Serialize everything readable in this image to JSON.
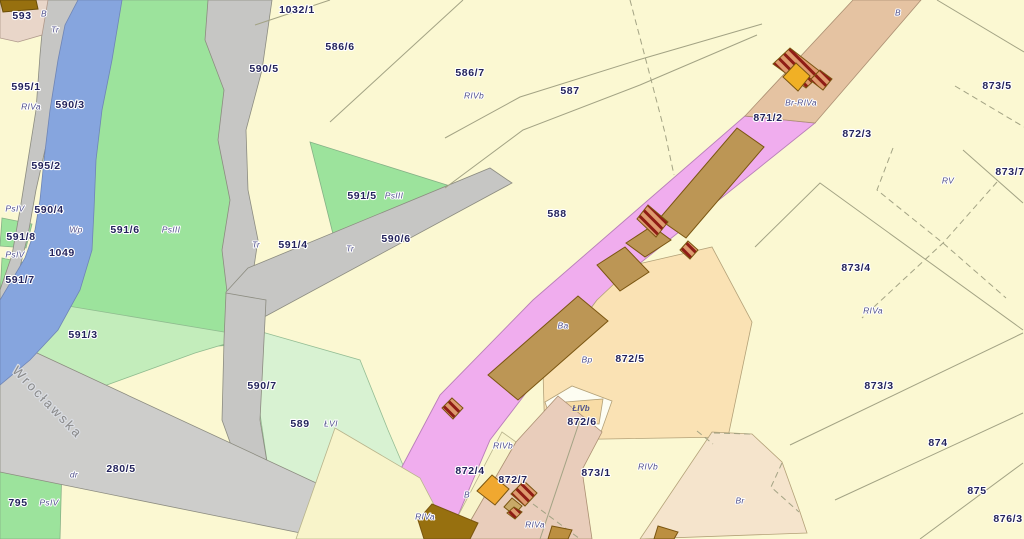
{
  "map": {
    "type": "cadastral-parcel-map",
    "street_label": "Wrocławska",
    "colors": {
      "background_parcel": "#FBF8D2",
      "meadow_green": "#9CE39C",
      "light_green": "#C3EDBB",
      "lighter_green": "#D8F2D2",
      "river_blue": "#86A5DE",
      "road_gray": "#C6C6C4",
      "railway_pink": "#F0ADEE",
      "building_brown": "#BC9655",
      "building_dark_brown": "#97700F",
      "building_orange": "#F0A830",
      "tan_band": "#E5C3A2",
      "tan_bottom": "#E9CDBB",
      "peach": "#FAE2B4",
      "ruin_hatch_red": "#8F1D15",
      "label_navy": "#23235C",
      "label_landuse": "#50508C"
    },
    "labels": [
      {
        "t": "593",
        "x": 22,
        "y": 16,
        "s": "p"
      },
      {
        "t": "B",
        "x": 44,
        "y": 14,
        "s": "l"
      },
      {
        "t": "Tr",
        "x": 55,
        "y": 30,
        "s": "l"
      },
      {
        "t": "1032/1",
        "x": 297,
        "y": 10,
        "s": "p"
      },
      {
        "t": "586/6",
        "x": 340,
        "y": 47,
        "s": "p"
      },
      {
        "t": "590/5",
        "x": 264,
        "y": 69,
        "s": "p"
      },
      {
        "t": "586/7",
        "x": 470,
        "y": 73,
        "s": "p"
      },
      {
        "t": "587",
        "x": 570,
        "y": 91,
        "s": "p"
      },
      {
        "t": "RIVb",
        "x": 474,
        "y": 96,
        "s": "l"
      },
      {
        "t": "595/1",
        "x": 26,
        "y": 87,
        "s": "p"
      },
      {
        "t": "590/3",
        "x": 70,
        "y": 105,
        "s": "p"
      },
      {
        "t": "RIVa",
        "x": 31,
        "y": 107,
        "s": "l"
      },
      {
        "t": "B",
        "x": 898,
        "y": 13,
        "s": "l"
      },
      {
        "t": "871/2",
        "x": 768,
        "y": 118,
        "s": "p"
      },
      {
        "t": "Br-RIVa",
        "x": 801,
        "y": 103,
        "s": "l"
      },
      {
        "t": "872/3",
        "x": 857,
        "y": 134,
        "s": "p"
      },
      {
        "t": "873/5",
        "x": 997,
        "y": 86,
        "s": "p"
      },
      {
        "t": "595/2",
        "x": 46,
        "y": 166,
        "s": "p"
      },
      {
        "t": "591/5",
        "x": 362,
        "y": 196,
        "s": "p"
      },
      {
        "t": "PsIII",
        "x": 394,
        "y": 196,
        "s": "l"
      },
      {
        "t": "873/7",
        "x": 1010,
        "y": 172,
        "s": "p"
      },
      {
        "t": "RV",
        "x": 948,
        "y": 181,
        "s": "l"
      },
      {
        "t": "PsIV",
        "x": 15,
        "y": 209,
        "s": "l"
      },
      {
        "t": "590/4",
        "x": 49,
        "y": 210,
        "s": "p"
      },
      {
        "t": "588",
        "x": 557,
        "y": 214,
        "s": "p"
      },
      {
        "t": "Wp",
        "x": 76,
        "y": 230,
        "s": "l"
      },
      {
        "t": "591/6",
        "x": 125,
        "y": 230,
        "s": "p"
      },
      {
        "t": "PsIII",
        "x": 171,
        "y": 230,
        "s": "l"
      },
      {
        "t": "591/8",
        "x": 21,
        "y": 237,
        "s": "p"
      },
      {
        "t": "1049",
        "x": 62,
        "y": 253,
        "s": "p"
      },
      {
        "t": "PsIV",
        "x": 15,
        "y": 255,
        "s": "l"
      },
      {
        "t": "Tr",
        "x": 256,
        "y": 245,
        "s": "l"
      },
      {
        "t": "591/4",
        "x": 293,
        "y": 245,
        "s": "p"
      },
      {
        "t": "Tr",
        "x": 350,
        "y": 249,
        "s": "l"
      },
      {
        "t": "590/6",
        "x": 396,
        "y": 239,
        "s": "p"
      },
      {
        "t": "591/7",
        "x": 20,
        "y": 280,
        "s": "p"
      },
      {
        "t": "873/4",
        "x": 856,
        "y": 268,
        "s": "p"
      },
      {
        "t": "RIVa",
        "x": 873,
        "y": 311,
        "s": "l"
      },
      {
        "t": "Ba",
        "x": 563,
        "y": 326,
        "s": "l"
      },
      {
        "t": "591/3",
        "x": 83,
        "y": 335,
        "s": "p"
      },
      {
        "t": "Bp",
        "x": 587,
        "y": 360,
        "s": "l"
      },
      {
        "t": "872/5",
        "x": 630,
        "y": 359,
        "s": "p"
      },
      {
        "t": "590/7",
        "x": 262,
        "y": 386,
        "s": "p"
      },
      {
        "t": "873/3",
        "x": 879,
        "y": 386,
        "s": "p"
      },
      {
        "t": "589",
        "x": 300,
        "y": 424,
        "s": "p"
      },
      {
        "t": "ŁVI",
        "x": 331,
        "y": 424,
        "s": "l"
      },
      {
        "t": "ŁIVb",
        "x": 581,
        "y": 409,
        "s": "l2"
      },
      {
        "t": "872/6",
        "x": 582,
        "y": 422,
        "s": "p"
      },
      {
        "t": "RIVb",
        "x": 503,
        "y": 446,
        "s": "l"
      },
      {
        "t": "872/4",
        "x": 470,
        "y": 471,
        "s": "p"
      },
      {
        "t": "873/1",
        "x": 596,
        "y": 473,
        "s": "p"
      },
      {
        "t": "RIVb",
        "x": 648,
        "y": 467,
        "s": "l"
      },
      {
        "t": "872/7",
        "x": 513,
        "y": 480,
        "s": "p"
      },
      {
        "t": "B",
        "x": 467,
        "y": 495,
        "s": "l"
      },
      {
        "t": "Br",
        "x": 740,
        "y": 501,
        "s": "l"
      },
      {
        "t": "874",
        "x": 938,
        "y": 443,
        "s": "p"
      },
      {
        "t": "280/5",
        "x": 121,
        "y": 469,
        "s": "p"
      },
      {
        "t": "dr",
        "x": 74,
        "y": 475,
        "s": "l"
      },
      {
        "t": "RIVa",
        "x": 425,
        "y": 517,
        "s": "l"
      },
      {
        "t": "RIVa",
        "x": 535,
        "y": 525,
        "s": "l"
      },
      {
        "t": "875",
        "x": 977,
        "y": 491,
        "s": "p"
      },
      {
        "t": "795",
        "x": 18,
        "y": 503,
        "s": "p"
      },
      {
        "t": "PsIV",
        "x": 49,
        "y": 503,
        "s": "l"
      },
      {
        "t": "876/3",
        "x": 1008,
        "y": 519,
        "s": "p"
      },
      {
        "t": "Wrocławska",
        "x": 47,
        "y": 403,
        "s": "street",
        "rot": 46
      }
    ]
  }
}
